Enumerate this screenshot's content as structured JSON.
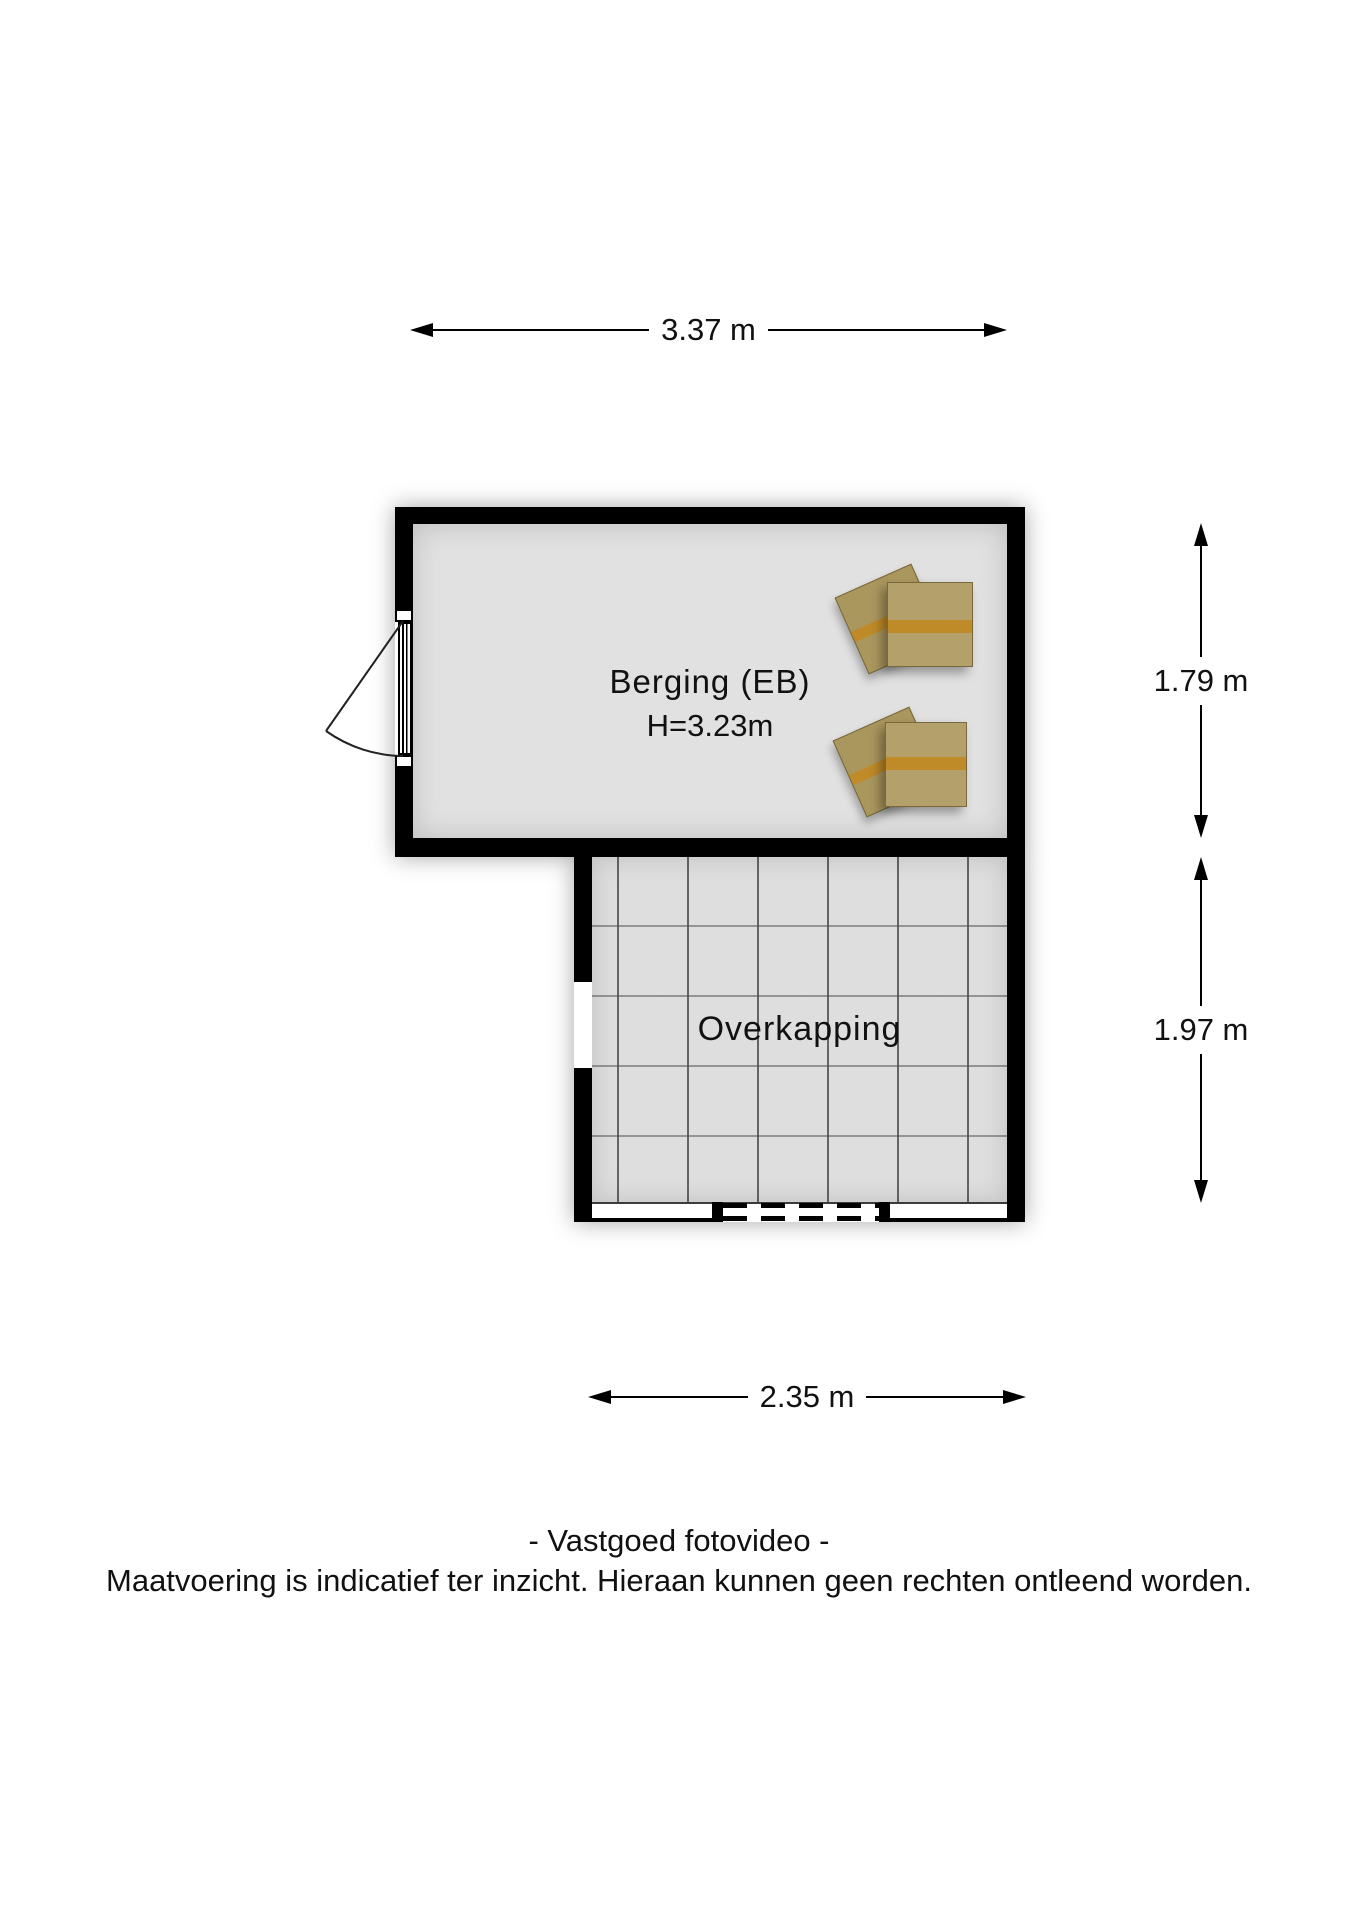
{
  "plan": {
    "rooms": [
      {
        "id": "berging",
        "label": "Berging (EB)",
        "height": "H=3.23m"
      },
      {
        "id": "overkapping",
        "label": "Overkapping"
      }
    ],
    "dimensions": {
      "top": "3.37 m",
      "right_upper": "1.79 m",
      "right_lower": "1.97 m",
      "bottom": "2.35 m"
    }
  },
  "footer": {
    "credit": "- Vastgoed fotovideo -",
    "disclaimer": "Maatvoering is indicatief ter inzicht. Hieraan kunnen geen rechten ontleend worden."
  },
  "colors": {
    "wall": "#000000",
    "floor_berging": "#e1e1e1",
    "floor_overkapping": "#dedede",
    "grid_line": "#7a7a7a",
    "box_tan": "#b3a06a",
    "box_strap": "#bf8a28",
    "text": "#111111"
  }
}
